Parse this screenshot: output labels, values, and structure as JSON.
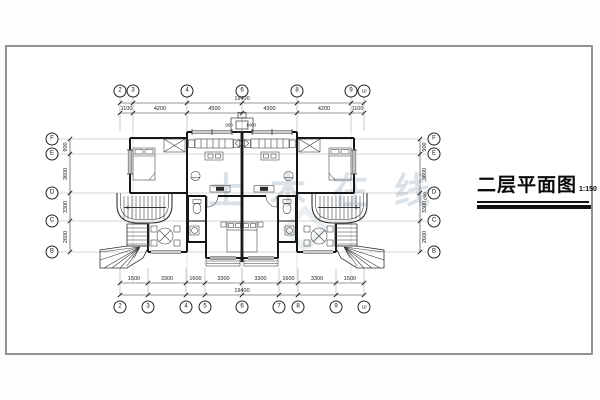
{
  "sheet": {
    "title": "二层平面图",
    "scale": "1:150",
    "watermark": "土木在线"
  },
  "grid": {
    "top_bubbles": [
      "2",
      "3",
      "4",
      "6",
      "8",
      "9",
      "10"
    ],
    "bottom_bubbles": [
      "2",
      "3",
      "4",
      "5",
      "6",
      "7",
      "8",
      "9",
      "10"
    ],
    "left_bubbles": [
      "F",
      "E",
      "D",
      "C",
      "B"
    ],
    "right_bubbles": [
      "F",
      "E",
      "D",
      "C",
      "B"
    ]
  },
  "dimensions": {
    "top_total": "19400",
    "top_segments": [
      "1100",
      "4200",
      "4500",
      "4300",
      "4200",
      "1100"
    ],
    "bottom_total": "19400",
    "bottom_segments": [
      "1500",
      "3300",
      "1600",
      "3300",
      "3300",
      "1600",
      "3300",
      "1500"
    ],
    "left_segments": [
      "900",
      "3600",
      "3300",
      "2600"
    ],
    "right_segments": [
      "900",
      "3600",
      "3300",
      "2600"
    ],
    "right_extra": "600",
    "porch_dims": [
      "900",
      "1400"
    ]
  }
}
